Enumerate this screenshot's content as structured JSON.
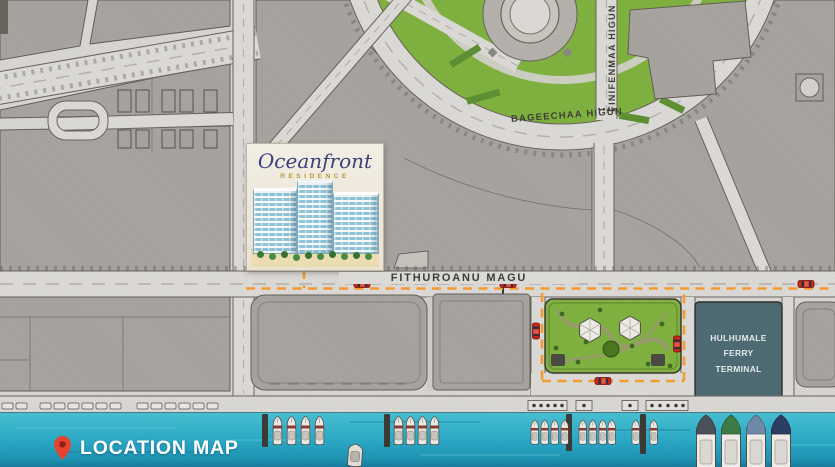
{
  "map": {
    "footer": {
      "label": "LOCATION MAP"
    },
    "logo": {
      "name": "Oceanfront",
      "subtitle": "RESIDENCE"
    },
    "roads": {
      "fithuroanu": "FITHUROANU MAGU",
      "bageechaa": "BAGEECHAA HIGUN",
      "finifenmaa": "FINIFENMAA HIGUN"
    },
    "ferry_terminal": {
      "line1": "HULHUMALE FERRY",
      "line2": "TERMINAL"
    },
    "colors": {
      "water": "#2ba6c2",
      "ground": "#d8d6d2",
      "plot": "#a7a39f",
      "road": "#dcdad6",
      "green": "#7fb13f",
      "terminal": "#4d6a73",
      "route": "#f59b30",
      "car": "#d22619",
      "pin": "#e8432e",
      "logo_name": "#3b3f7c",
      "logo_subtitle": "#bd9335"
    }
  }
}
